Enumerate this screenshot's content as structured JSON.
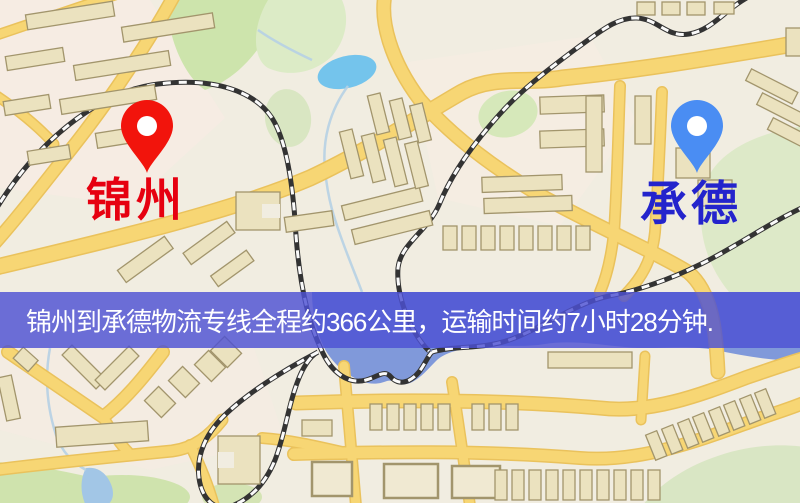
{
  "origin": {
    "label": "锦州",
    "pin_color": "#f2140c",
    "label_color": "#e60010"
  },
  "destination": {
    "label": "承德",
    "pin_color": "#4a8df3",
    "label_color": "#2424cc"
  },
  "banner": {
    "text": "锦州到承德物流专线全程约366公里，运输时间约7小时28分钟.",
    "background_color": "#4d51d3",
    "text_color": "#ffffff"
  },
  "route": {
    "from": "锦州",
    "to": "承德",
    "distance_km": 366,
    "duration_hours": 7,
    "duration_minutes": 28
  }
}
